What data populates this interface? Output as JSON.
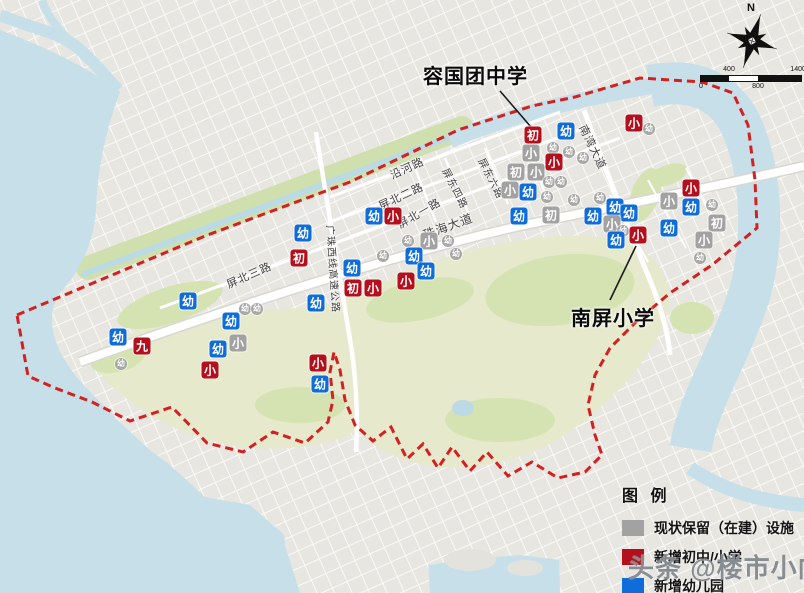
{
  "compass": {
    "north_label": "N"
  },
  "scale_bar": {
    "labels": [
      {
        "t": "0",
        "x": 0,
        "pos": "bot"
      },
      {
        "t": "400",
        "x": 28,
        "pos": "top"
      },
      {
        "t": "800",
        "x": 57,
        "pos": "bot"
      },
      {
        "t": "1400M",
        "x": 100,
        "pos": "top"
      }
    ]
  },
  "callouts": [
    {
      "text": "容国团中学"
    },
    {
      "text": "南屏小学"
    }
  ],
  "legend": {
    "title": "图 例",
    "items": [
      {
        "label": "现状保留（在建）设施",
        "color": "#a2a2a2"
      },
      {
        "label": "新增初中/小学",
        "color": "#b30f1c"
      },
      {
        "label": "新增幼儿园",
        "color": "#0f6ddb"
      }
    ]
  },
  "watermark": {
    "text": "头条 @楼市小向"
  },
  "map": {
    "boundary_color": "#d42020",
    "water_color": "#c6dfe9",
    "park_color": "#e6e9cb",
    "road_labels": [
      {
        "text": "沿河路",
        "x": 407,
        "y": 168,
        "rot": -25,
        "fs": 11
      },
      {
        "text": "屏北二路",
        "x": 401,
        "y": 196,
        "rot": -25,
        "fs": 11
      },
      {
        "text": "屏北一路",
        "x": 419,
        "y": 213,
        "rot": -30,
        "fs": 11
      },
      {
        "text": "屏北三路",
        "x": 249,
        "y": 275,
        "rot": -24,
        "fs": 11
      },
      {
        "text": "屏东四路",
        "x": 456,
        "y": 188,
        "rot": 63,
        "fs": 10
      },
      {
        "text": "屏东六路",
        "x": 492,
        "y": 178,
        "rot": 63,
        "fs": 10
      },
      {
        "text": "珠海大道",
        "x": 448,
        "y": 226,
        "rot": -20,
        "fs": 12
      },
      {
        "text": "南湾大道",
        "x": 593,
        "y": 147,
        "rot": 64,
        "fs": 11
      },
      {
        "text": "广珠西线高速公路",
        "x": 334,
        "y": 269,
        "rot": 86,
        "fs": 10
      }
    ],
    "markers": [
      {
        "t": "初",
        "c": "r",
        "x": 533,
        "y": 135,
        "s": "l"
      },
      {
        "t": "幼",
        "c": "b",
        "x": 566,
        "y": 131,
        "s": "l"
      },
      {
        "t": "小",
        "c": "g",
        "x": 531,
        "y": 153,
        "s": "l"
      },
      {
        "t": "幼",
        "c": "g",
        "x": 553,
        "y": 148,
        "s": "s"
      },
      {
        "t": "幼",
        "c": "g",
        "x": 569,
        "y": 152,
        "s": "s"
      },
      {
        "t": "幼",
        "c": "g",
        "x": 583,
        "y": 158,
        "s": "s"
      },
      {
        "t": "小",
        "c": "r",
        "x": 554,
        "y": 162,
        "s": "l"
      },
      {
        "t": "初",
        "c": "g",
        "x": 516,
        "y": 172,
        "s": "l"
      },
      {
        "t": "小",
        "c": "g",
        "x": 536,
        "y": 172,
        "s": "l"
      },
      {
        "t": "幼",
        "c": "g",
        "x": 549,
        "y": 182,
        "s": "s"
      },
      {
        "t": "幼",
        "c": "g",
        "x": 561,
        "y": 182,
        "s": "s"
      },
      {
        "t": "小",
        "c": "g",
        "x": 510,
        "y": 190,
        "s": "l"
      },
      {
        "t": "幼",
        "c": "b",
        "x": 528,
        "y": 192,
        "s": "l"
      },
      {
        "t": "幼",
        "c": "g",
        "x": 547,
        "y": 197,
        "s": "s"
      },
      {
        "t": "幼",
        "c": "g",
        "x": 574,
        "y": 200,
        "s": "s"
      },
      {
        "t": "幼",
        "c": "g",
        "x": 600,
        "y": 198,
        "s": "s"
      },
      {
        "t": "初",
        "c": "g",
        "x": 551,
        "y": 215,
        "s": "l"
      },
      {
        "t": "幼",
        "c": "b",
        "x": 519,
        "y": 216,
        "s": "l"
      },
      {
        "t": "幼",
        "c": "b",
        "x": 593,
        "y": 216,
        "s": "l"
      },
      {
        "t": "小",
        "c": "r",
        "x": 634,
        "y": 123,
        "s": "l"
      },
      {
        "t": "幼",
        "c": "g",
        "x": 649,
        "y": 129,
        "s": "s"
      },
      {
        "t": "幼",
        "c": "b",
        "x": 615,
        "y": 207,
        "s": "l"
      },
      {
        "t": "幼",
        "c": "b",
        "x": 629,
        "y": 213,
        "s": "l"
      },
      {
        "t": "小",
        "c": "g",
        "x": 612,
        "y": 224,
        "s": "l"
      },
      {
        "t": "幼",
        "c": "g",
        "x": 623,
        "y": 231,
        "s": "s"
      },
      {
        "t": "幼",
        "c": "b",
        "x": 616,
        "y": 240,
        "s": "l"
      },
      {
        "t": "小",
        "c": "r",
        "x": 638,
        "y": 235,
        "s": "l"
      },
      {
        "t": "小",
        "c": "r",
        "x": 691,
        "y": 188,
        "s": "l"
      },
      {
        "t": "小",
        "c": "g",
        "x": 669,
        "y": 201,
        "s": "l"
      },
      {
        "t": "幼",
        "c": "b",
        "x": 691,
        "y": 207,
        "s": "l"
      },
      {
        "t": "幼",
        "c": "g",
        "x": 712,
        "y": 205,
        "s": "s"
      },
      {
        "t": "初",
        "c": "g",
        "x": 717,
        "y": 223,
        "s": "l"
      },
      {
        "t": "幼",
        "c": "b",
        "x": 669,
        "y": 228,
        "s": "l"
      },
      {
        "t": "小",
        "c": "g",
        "x": 704,
        "y": 240,
        "s": "l"
      },
      {
        "t": "幼",
        "c": "g",
        "x": 700,
        "y": 258,
        "s": "s"
      },
      {
        "t": "幼",
        "c": "b",
        "x": 374,
        "y": 216,
        "s": "l"
      },
      {
        "t": "小",
        "c": "r",
        "x": 393,
        "y": 216,
        "s": "l"
      },
      {
        "t": "幼",
        "c": "g",
        "x": 408,
        "y": 241,
        "s": "s"
      },
      {
        "t": "小",
        "c": "g",
        "x": 429,
        "y": 241,
        "s": "l"
      },
      {
        "t": "幼",
        "c": "g",
        "x": 448,
        "y": 241,
        "s": "s"
      },
      {
        "t": "幼",
        "c": "g",
        "x": 456,
        "y": 254,
        "s": "s"
      },
      {
        "t": "幼",
        "c": "g",
        "x": 383,
        "y": 256,
        "s": "s"
      },
      {
        "t": "幼",
        "c": "b",
        "x": 414,
        "y": 256,
        "s": "l"
      },
      {
        "t": "幼",
        "c": "b",
        "x": 352,
        "y": 268,
        "s": "l"
      },
      {
        "t": "幼",
        "c": "b",
        "x": 426,
        "y": 271,
        "s": "l"
      },
      {
        "t": "小",
        "c": "r",
        "x": 406,
        "y": 281,
        "s": "l"
      },
      {
        "t": "初",
        "c": "r",
        "x": 353,
        "y": 288,
        "s": "l"
      },
      {
        "t": "小",
        "c": "r",
        "x": 373,
        "y": 288,
        "s": "l"
      },
      {
        "t": "幼",
        "c": "b",
        "x": 316,
        "y": 303,
        "s": "l"
      },
      {
        "t": "幼",
        "c": "b",
        "x": 303,
        "y": 233,
        "s": "l"
      },
      {
        "t": "初",
        "c": "r",
        "x": 299,
        "y": 258,
        "s": "l"
      },
      {
        "t": "幼",
        "c": "b",
        "x": 188,
        "y": 301,
        "s": "l"
      },
      {
        "t": "幼",
        "c": "g",
        "x": 245,
        "y": 309,
        "s": "s"
      },
      {
        "t": "幼",
        "c": "g",
        "x": 257,
        "y": 309,
        "s": "s"
      },
      {
        "t": "幼",
        "c": "b",
        "x": 231,
        "y": 321,
        "s": "l"
      },
      {
        "t": "幼",
        "c": "b",
        "x": 118,
        "y": 337,
        "s": "l"
      },
      {
        "t": "九",
        "c": "r",
        "x": 142,
        "y": 346,
        "s": "l"
      },
      {
        "t": "小",
        "c": "g",
        "x": 238,
        "y": 343,
        "s": "l"
      },
      {
        "t": "幼",
        "c": "b",
        "x": 218,
        "y": 349,
        "s": "l"
      },
      {
        "t": "幼",
        "c": "g",
        "x": 121,
        "y": 364,
        "s": "s"
      },
      {
        "t": "小",
        "c": "r",
        "x": 210,
        "y": 370,
        "s": "l"
      },
      {
        "t": "小",
        "c": "r",
        "x": 318,
        "y": 363,
        "s": "l"
      },
      {
        "t": "幼",
        "c": "b",
        "x": 320,
        "y": 384,
        "s": "l"
      }
    ]
  }
}
